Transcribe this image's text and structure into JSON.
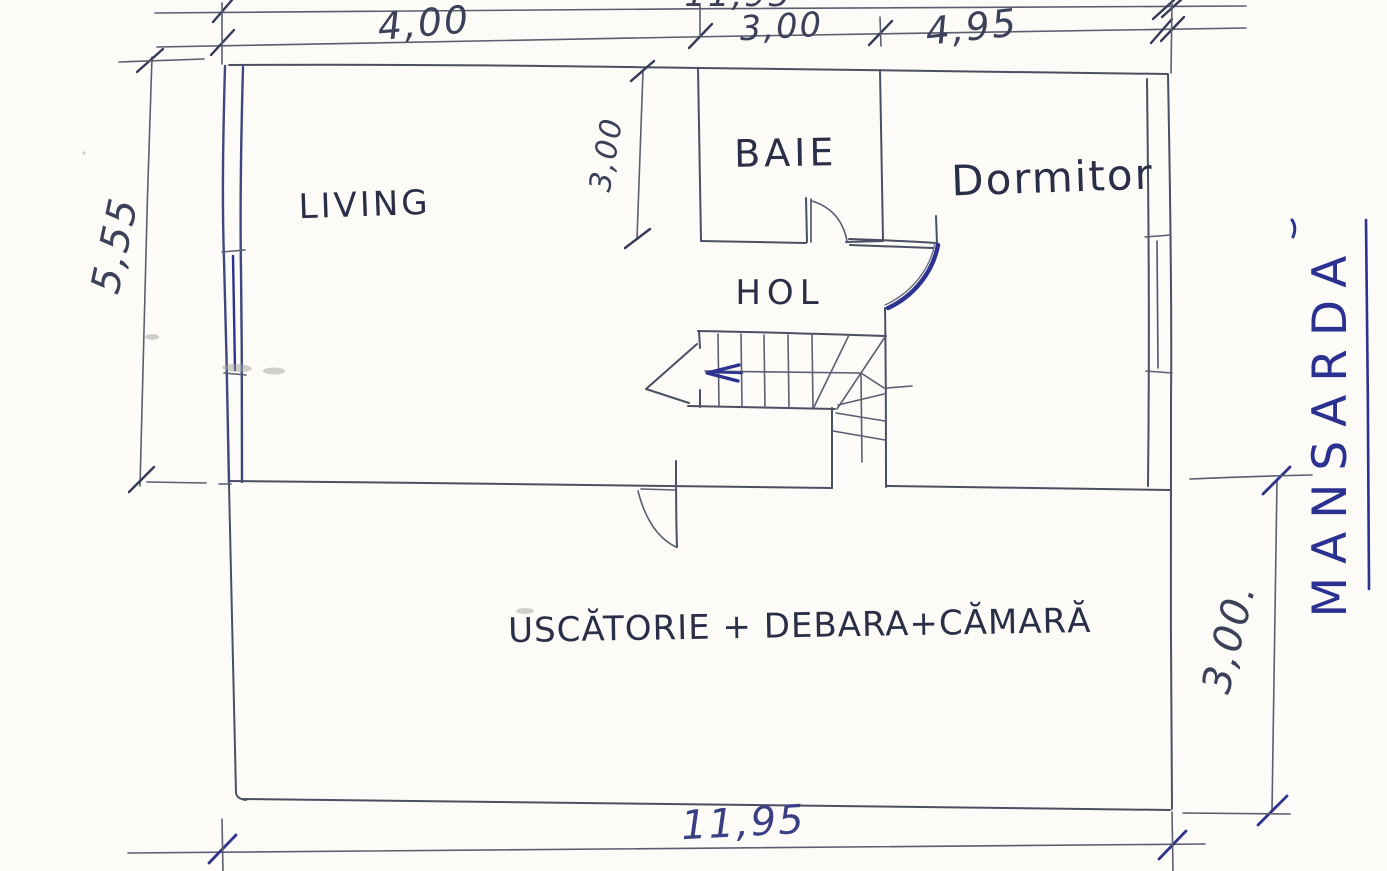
{
  "floor": {
    "label": "MANSARDA"
  },
  "rooms": {
    "living": "LIVING",
    "baie": "BAIE",
    "dormitor": "Dormitor",
    "hol": "HOL",
    "service": "USCĂTORIE + DEBARA+CĂMARĂ"
  },
  "dimensions": {
    "top_overall": "11,95",
    "top_left": "4,00",
    "top_mid": "3,00",
    "top_right": "4,95",
    "left": "5,55",
    "baie_depth": "3,00",
    "right": "3,00.",
    "bottom": "11,95"
  },
  "annotations": {
    "stair_direction_arrow": "left",
    "drawing_style": "hand-drawn pen sketch"
  },
  "colors": {
    "paper": "#fcfbf7",
    "pencil_line": "#4b4f63",
    "ink_blue": "#2c3290"
  }
}
